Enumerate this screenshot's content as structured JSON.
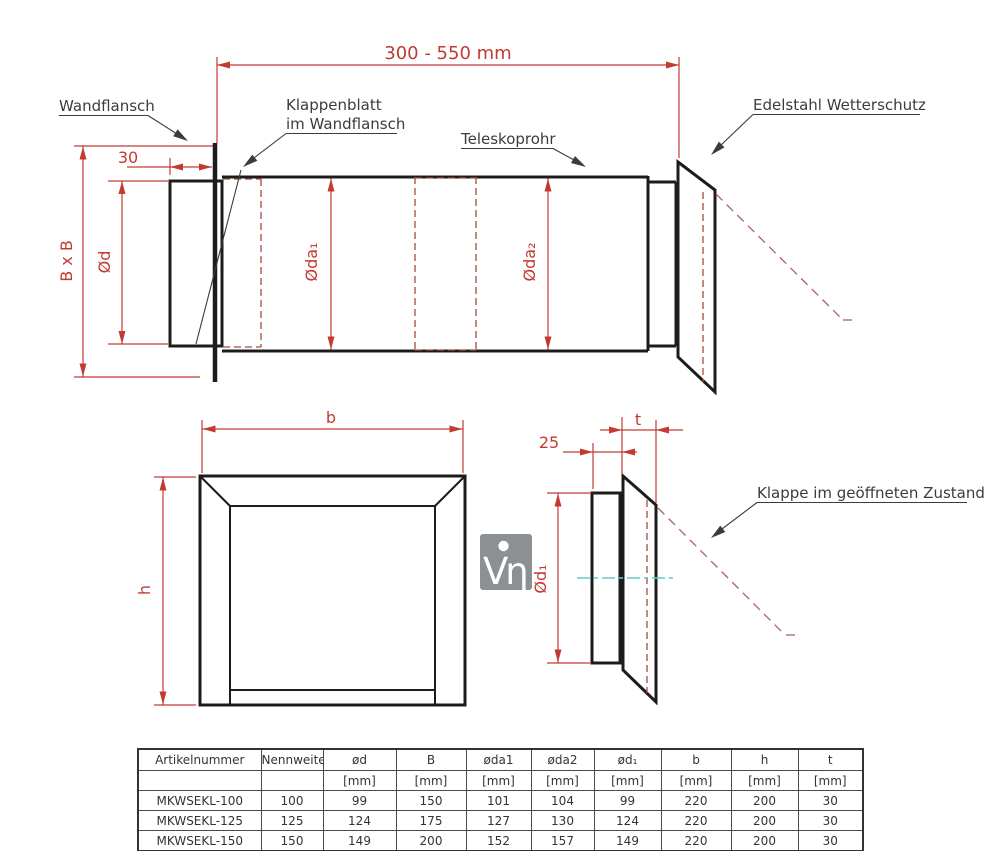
{
  "drawing": {
    "top_view": {
      "dim_length_range": "300 - 550 mm",
      "dim_flange_depth": "30",
      "dim_duct_square": "B x B",
      "dim_inner_diameter": "Ød",
      "dim_outer_diameter_1": "Øda₁",
      "dim_outer_diameter_2": "Øda₂",
      "label_wall_flange": "Wandflansch",
      "label_flap_line1": "Klappenblatt",
      "label_flap_line2": "im Wandflansch",
      "label_telescopic_tube": "Teleskoprohr",
      "label_weather_guard": "Edelstahl Wetterschutz"
    },
    "front_view": {
      "dim_width": "b",
      "dim_height": "h"
    },
    "side_view": {
      "dim_offset": "25",
      "dim_thickness": "t",
      "dim_flap_diameter": "Ød₁",
      "label_open_flap": "Klappe im geöffneten Zustand"
    }
  },
  "logo": {
    "glyph": "Vη"
  },
  "table": {
    "headers": [
      "Artikelnummer",
      "Nennweite",
      "ød",
      "B",
      "øda1",
      "øda2",
      "ød₁",
      "b",
      "h",
      "t"
    ],
    "units": [
      "",
      "",
      "[mm]",
      "[mm]",
      "[mm]",
      "[mm]",
      "[mm]",
      "[mm]",
      "[mm]",
      "[mm]"
    ],
    "rows": [
      [
        "MKWSEKL-100",
        "100",
        "99",
        "150",
        "101",
        "104",
        "99",
        "220",
        "200",
        "30"
      ],
      [
        "MKWSEKL-125",
        "125",
        "124",
        "175",
        "127",
        "130",
        "124",
        "220",
        "200",
        "30"
      ],
      [
        "MKWSEKL-150",
        "150",
        "149",
        "200",
        "152",
        "157",
        "149",
        "220",
        "200",
        "30"
      ]
    ]
  },
  "colors": {
    "dimension_red": "#c23b32",
    "hidden_line_red": "#a84a40",
    "open_flap_red": "#a8625a",
    "centerline_cyan": "#5fd0c5",
    "line_black": "#1c1c1c",
    "logo_gray": "#8c9093"
  }
}
